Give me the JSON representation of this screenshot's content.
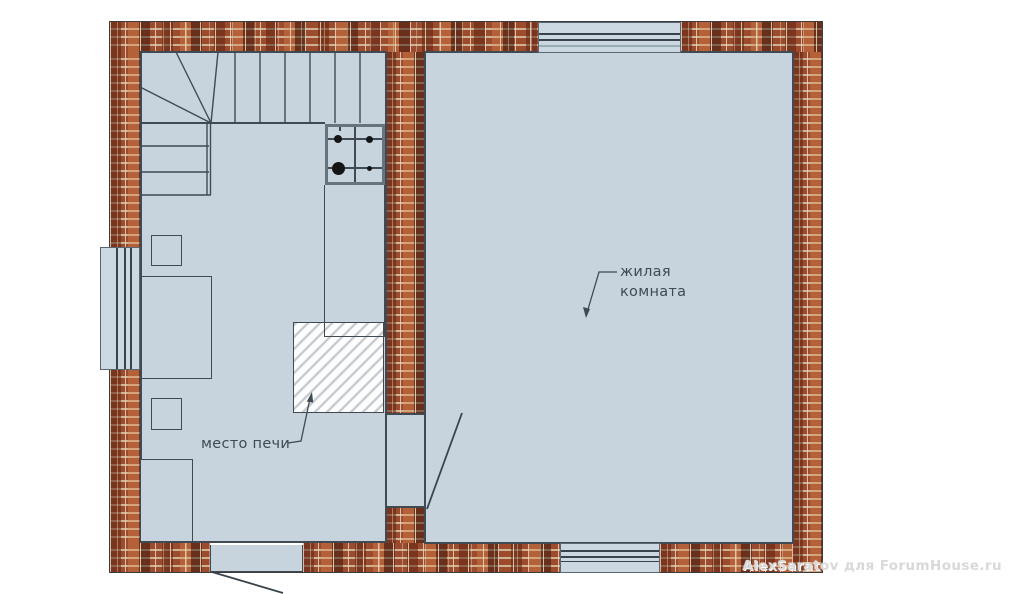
{
  "labels": {
    "living_room": {
      "line1": "жилая",
      "line2": "комната"
    },
    "stove_place": "место печи"
  },
  "watermark": "AlexSaratov для ForumHouse.ru",
  "colors": {
    "background": "#ffffff",
    "floor": "#c7d4de",
    "wall_brick": "#9c4c2d",
    "mortar": "#cdb393",
    "line": "#3f4a52",
    "hatch_line": "#c9cdd1",
    "burner": "#151515",
    "watermark_text": "#d9d9d9"
  },
  "elements": {
    "rooms": [
      "жилая комната"
    ],
    "features": [
      "brick-walls",
      "staircase-winder",
      "stove-cooktop",
      "flue-outline",
      "stove-place-hatch",
      "table",
      "stool-upper",
      "stool-lower",
      "cabinet",
      "window-left",
      "window-top",
      "window-bottom",
      "entrance-doorway",
      "interior-doorway"
    ]
  }
}
